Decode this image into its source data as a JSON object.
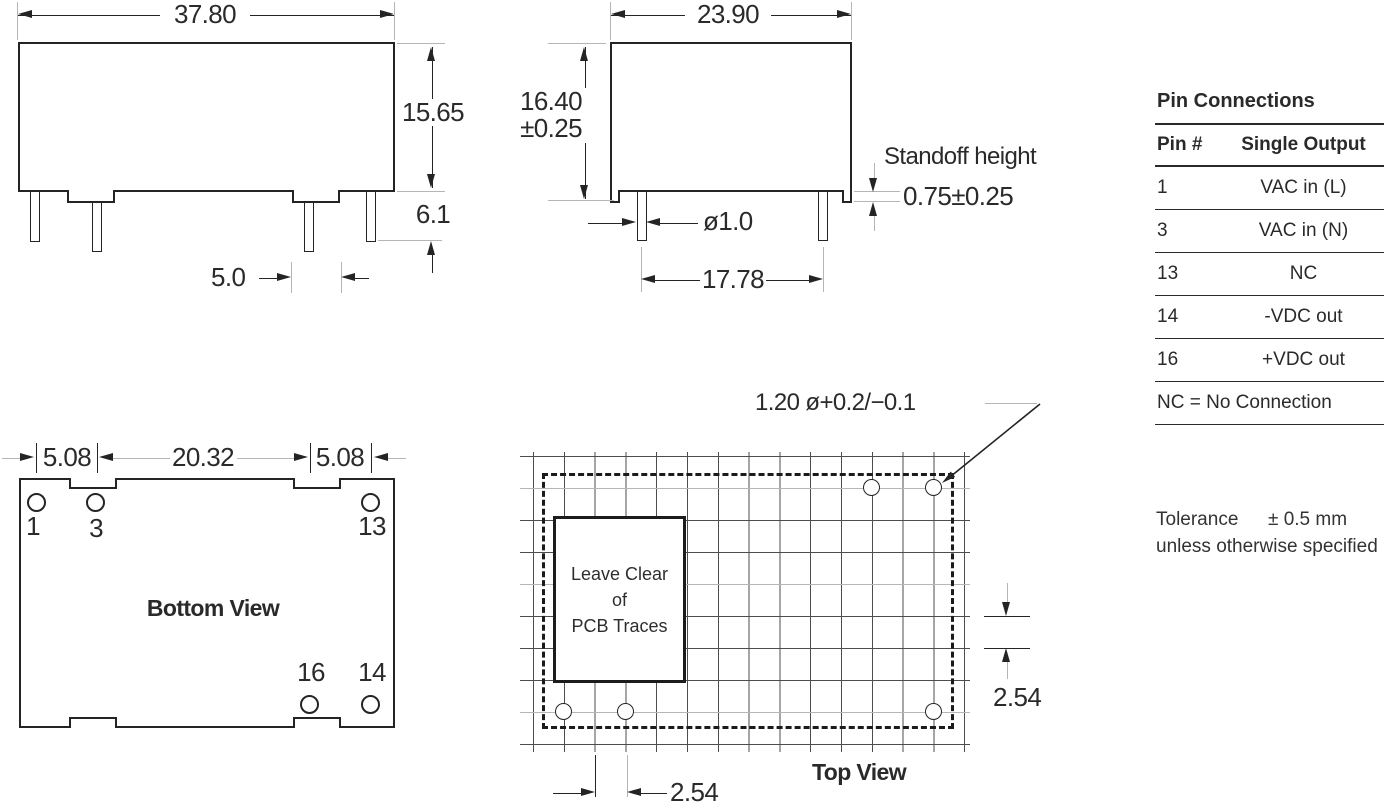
{
  "front_view": {
    "width_dim": "37.80",
    "height_dim": "15.65",
    "pin_length_dim": "6.1",
    "foot_width_dim": "5.0"
  },
  "side_view": {
    "width_dim": "23.90",
    "height_dim": "16.40",
    "height_tol": "±0.25",
    "standoff_label": "Standoff height",
    "standoff_dim": "0.75±0.25",
    "pin_dia_dim": "ø1.0",
    "pin_pitch_dim": "17.78"
  },
  "bottom_view": {
    "title": "Bottom View",
    "dim_left": "5.08",
    "dim_center": "20.32",
    "dim_right": "5.08",
    "pin_labels": {
      "p1": "1",
      "p3": "3",
      "p13": "13",
      "p16": "16",
      "p14": "14"
    }
  },
  "top_view": {
    "title": "Top View",
    "hole_callout": "1.20 ø+0.2/−0.1",
    "keepout": {
      "line1": "Leave Clear",
      "line2": "of",
      "line3": "PCB Traces"
    },
    "row_pitch_dim": "2.54",
    "col_pitch_dim": "2.54"
  },
  "pin_table": {
    "title": "Pin Connections",
    "headers": {
      "pin": "Pin #",
      "output": "Single Output"
    },
    "rows": [
      {
        "pin": "1",
        "output": "VAC in (L)"
      },
      {
        "pin": "3",
        "output": "VAC in (N)"
      },
      {
        "pin": "13",
        "output": "NC"
      },
      {
        "pin": "14",
        "output": "-VDC out"
      },
      {
        "pin": "16",
        "output": "+VDC out"
      }
    ],
    "footnote": "NC = No Connection"
  },
  "tolerance_note": {
    "label": "Tolerance",
    "value": "± 0.5 mm",
    "line2": "unless otherwise specified"
  }
}
